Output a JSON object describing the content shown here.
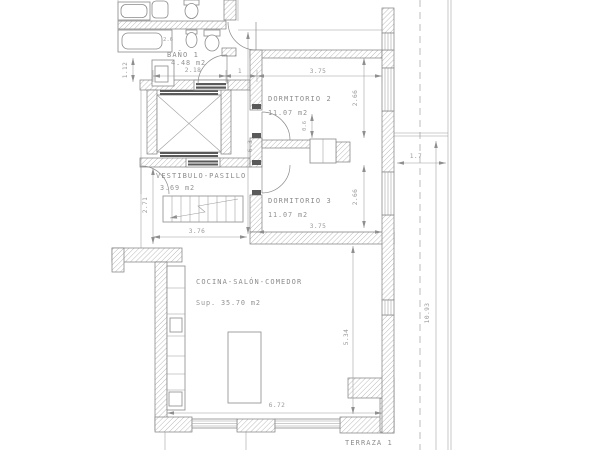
{
  "plan": {
    "rooms": [
      {
        "name": "BAÑO 1",
        "area": "4.48 m2"
      },
      {
        "name": "DORMITORIO 2",
        "area": "11.07 m2"
      },
      {
        "name": "DORMITORIO 3",
        "area": "11.07 m2"
      },
      {
        "name": "VESTIBULO-PASILLO",
        "area": "3.69 m2"
      },
      {
        "name": "COCINA-SALÓN-COMEDOR",
        "area": "Sup. 35.70 m2"
      },
      {
        "name": "TERRAZA 1",
        "area": "Sup. 18.58 m2"
      }
    ],
    "dimensions": {
      "bano_width": "2.18",
      "bano_left": "1.12",
      "bano_inner": "2.6",
      "hall_width": "1",
      "dorm2_width": "3.75",
      "dorm2_depth": "2.66",
      "closet_depth": "0.6",
      "core_depth": "6.3",
      "vest_depth": "2.71",
      "stair_width": "3.76",
      "dorm3_width": "3.75",
      "dorm3_depth": "2.66",
      "terraza_width": "1.7",
      "terraza_length": "10.93",
      "salon_depth": "5.34",
      "salon_width": "6.72"
    },
    "colors": {
      "background": "#ffffff",
      "line": "#8f8f8f",
      "wall_outline": "#7a7a7a",
      "dark_fill": "#5a5a5a",
      "text": "#8f8f8f"
    }
  }
}
